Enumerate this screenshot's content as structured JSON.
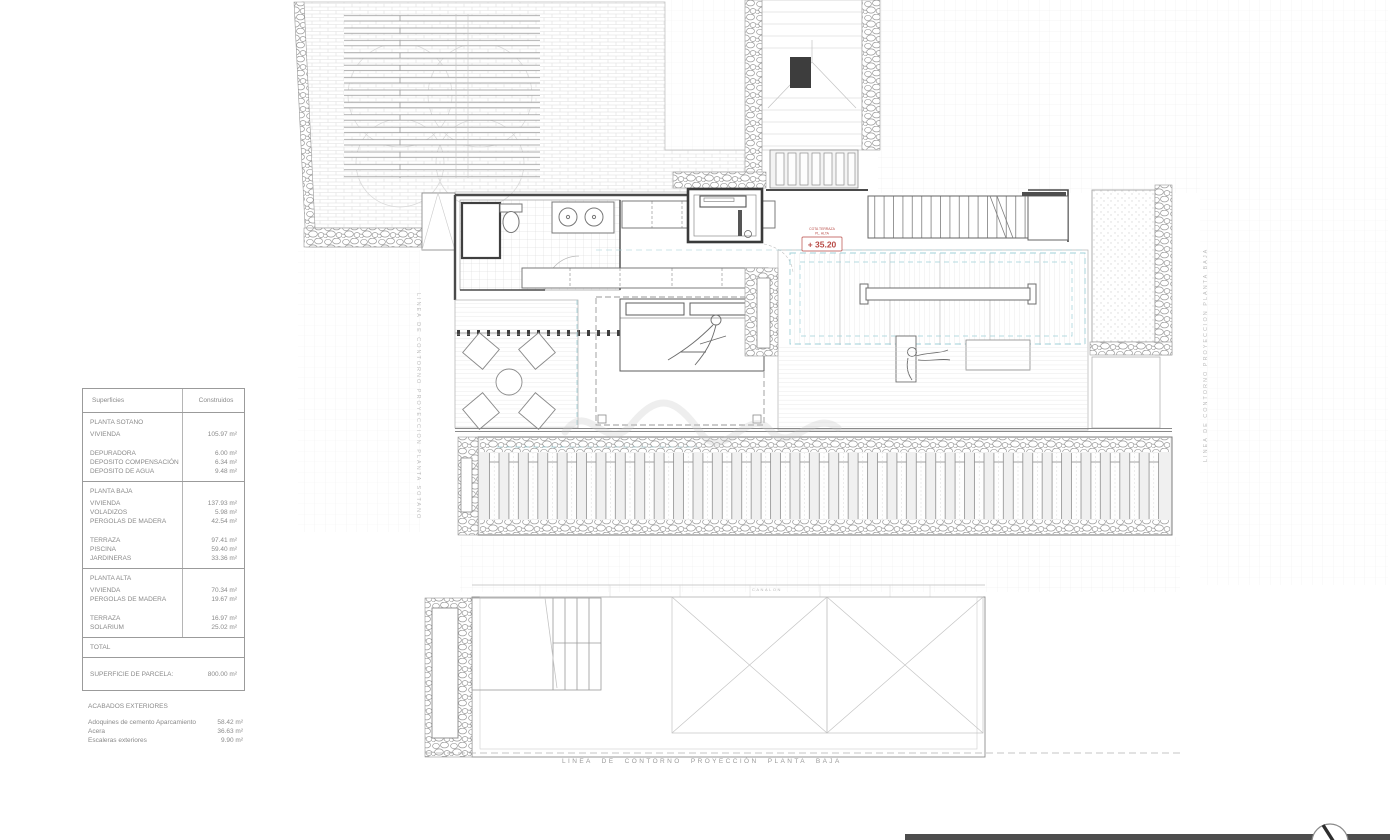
{
  "areas_table": {
    "headers": [
      "Superficies",
      "Construidos"
    ],
    "sections": [
      {
        "title": "PLANTA SOTANO",
        "rows": [
          {
            "label": "VIVIENDA",
            "value": "105.97 m²"
          },
          {
            "label": "DEPURADORA",
            "value": "6.00 m²"
          },
          {
            "label": "DEPOSITO COMPENSACIÓN",
            "value": "6.34 m²"
          },
          {
            "label": "DEPOSITO DE AGUA",
            "value": "9.48 m²"
          }
        ]
      },
      {
        "title": "PLANTA BAJA",
        "rows": [
          {
            "label": "VIVIENDA",
            "value": "137.93 m²"
          },
          {
            "label": "VOLADIZOS",
            "value": "5.98 m²"
          },
          {
            "label": "PERGOLAS DE MADERA",
            "value": "42.54 m²"
          },
          {
            "label": "TERRAZA",
            "value": "97.41 m²"
          },
          {
            "label": "PISCINA",
            "value": "59.40 m²"
          },
          {
            "label": "JARDINERAS",
            "value": "33.36 m²"
          }
        ]
      },
      {
        "title": "PLANTA ALTA",
        "rows": [
          {
            "label": "VIVIENDA",
            "value": "70.34 m²"
          },
          {
            "label": "PERGOLAS DE MADERA",
            "value": "19.67 m²"
          },
          {
            "label": "TERRAZA",
            "value": "16.97 m²"
          },
          {
            "label": "SOLARIUM",
            "value": "25.02 m²"
          }
        ]
      }
    ],
    "total_label": "TOTAL",
    "parcel": {
      "label": "SUPERFICIE DE PARCELA:",
      "value": "800.00 m²"
    }
  },
  "exterior_finishes": {
    "title": "ACABADOS EXTERIORES",
    "rows": [
      {
        "label": "Adoquines de cemento Aparcamiento",
        "value": "58.42 m²"
      },
      {
        "label": "Acera",
        "value": "36.63 m²"
      },
      {
        "label": "Escaleras exteriores",
        "value": "9.90 m²"
      }
    ]
  },
  "plan": {
    "level_marker": {
      "label_line1": "COTA TERRAZA",
      "label_line2": "PL. ALTA",
      "value": "+ 35.20",
      "color": "#b84a45"
    },
    "annotations": {
      "left_vertical": "LINEA DE CONTORNO PROYECCION PLANTA SOTANO",
      "right_vertical": "LINEA DE CONTORNO PROYECCION PLANTA BAJA",
      "bottom": "LINEA DE CONTORNO PROYECCIÓN PLANTA BAJA",
      "gutter": "CANALON"
    },
    "colors": {
      "projection_dash": "#9fd0d8",
      "walls": "#4a4a4a",
      "accent_red": "#b84a45"
    }
  }
}
